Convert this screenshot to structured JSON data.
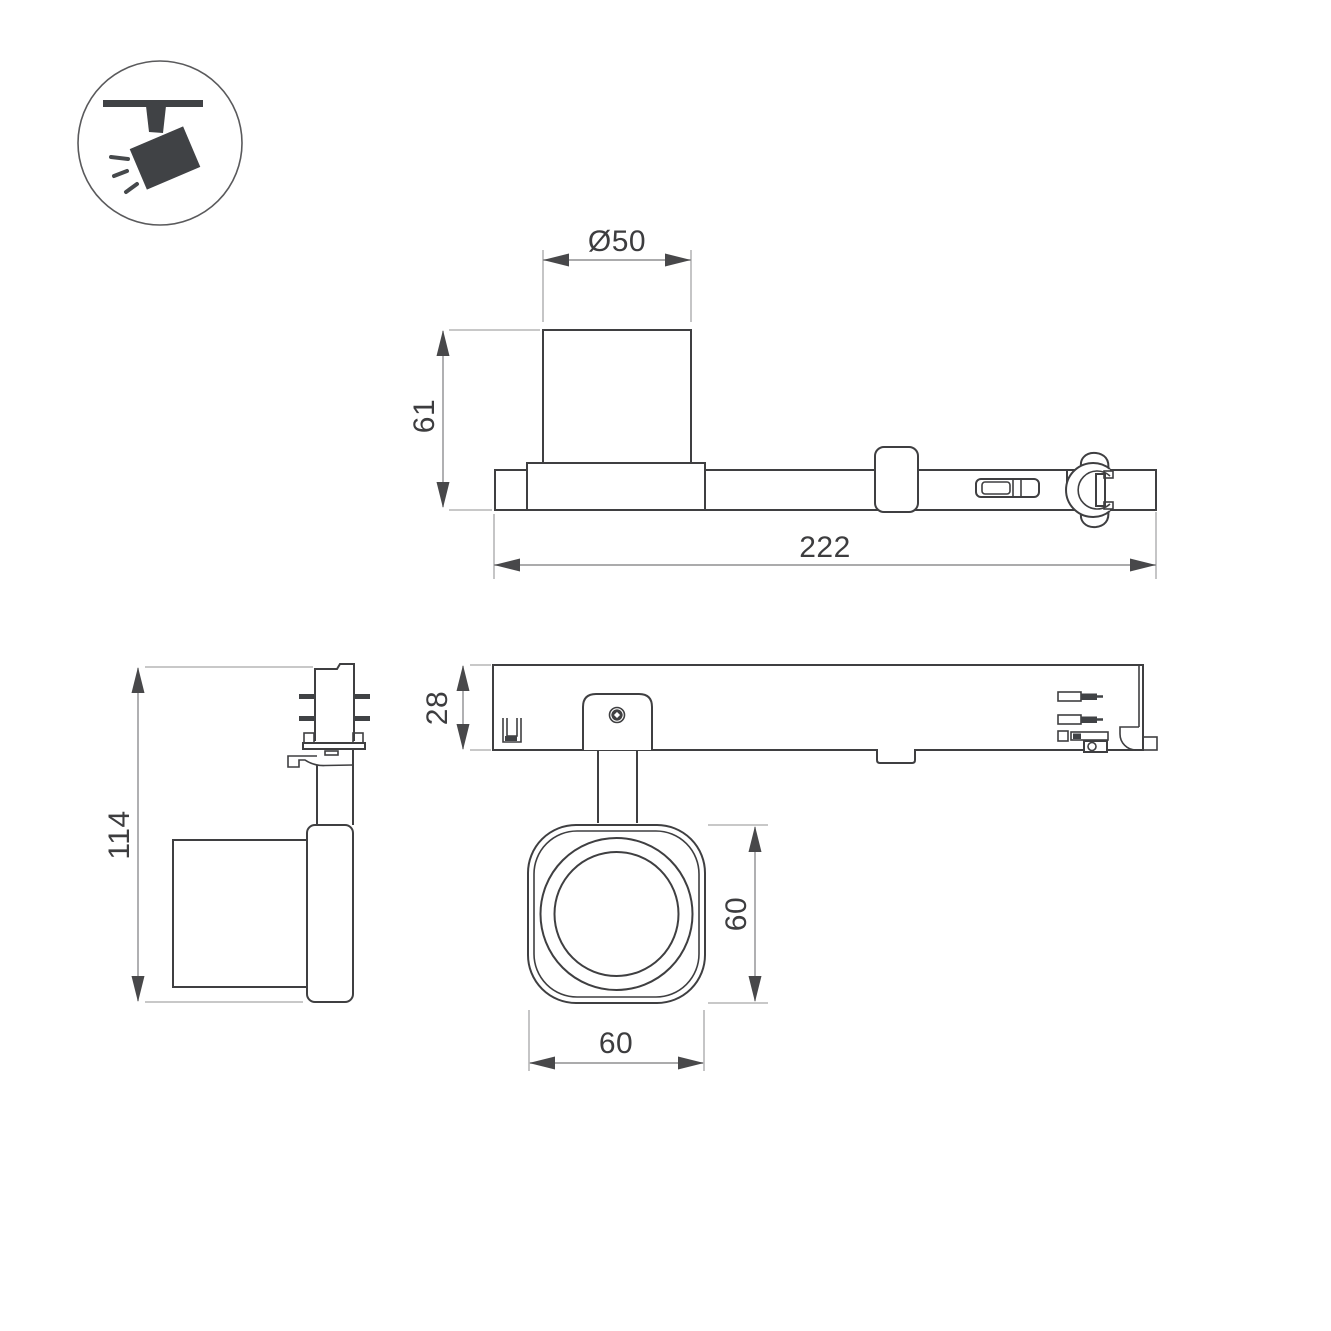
{
  "drawing": {
    "title": "track-spotlight-dimension-drawing",
    "icon": {
      "name": "track-spotlight-icon"
    },
    "views": {
      "side": {
        "name": "side-elevation",
        "dims": {
          "diameter": "Ø50",
          "height": "61",
          "length": "222"
        }
      },
      "front": {
        "name": "front-elevation",
        "dims": {
          "height": "114"
        }
      },
      "bottom": {
        "name": "bottom-view",
        "dims": {
          "depth": "28",
          "head_width": "60",
          "head_height": "60"
        }
      }
    },
    "colors": {
      "outline": "#3f3f41",
      "thin_line": "#a6a6a8",
      "dimension_line": "#8f8f91",
      "arrow": "#48484a",
      "text": "#3d3d3f",
      "icon_fill": "#46494c",
      "background": "#ffffff"
    }
  }
}
